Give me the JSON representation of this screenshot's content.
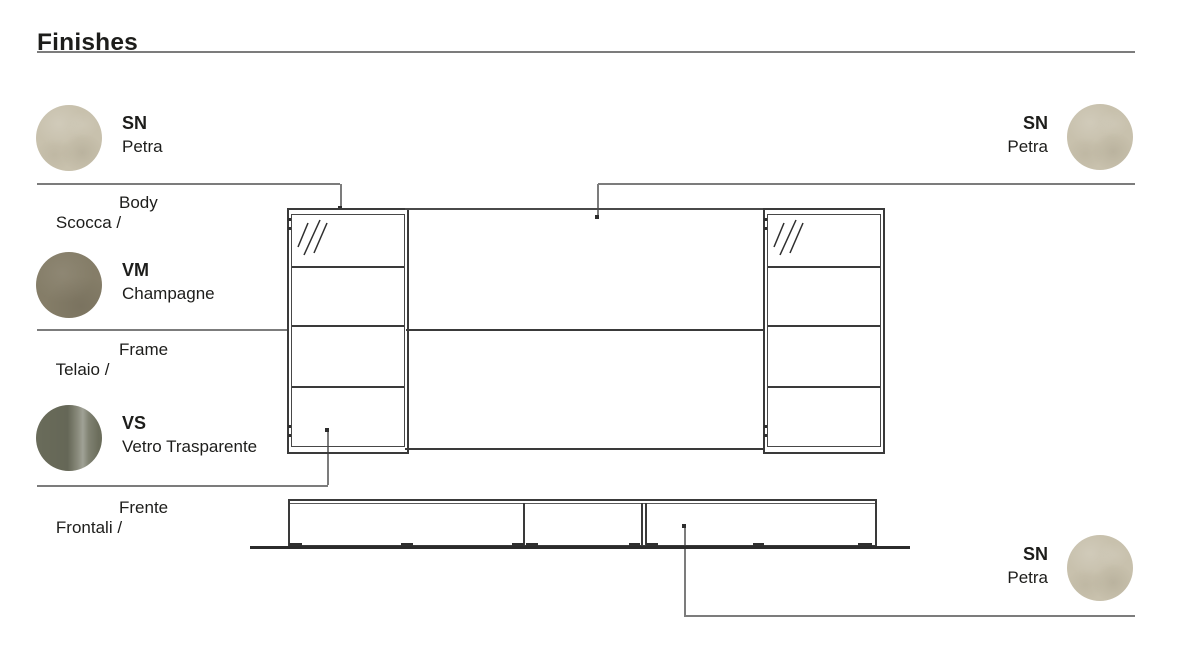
{
  "page": {
    "title": "Finishes"
  },
  "sections": {
    "body": {
      "label_primary": "Scocca /",
      "label_secondary": "Body",
      "swatch": {
        "code": "SN",
        "name": "Petra",
        "color": "#c8c1ad"
      }
    },
    "frame": {
      "label_primary": "Telaio /",
      "label_secondary": "Frame",
      "swatch": {
        "code": "VM",
        "name": "Champagne",
        "color": "#857d68"
      }
    },
    "front": {
      "label_primary": "Frontali /",
      "label_secondary": "Frente",
      "swatch": {
        "code": "VS",
        "name": "Vetro Trasparente",
        "color": "#6f715f"
      }
    },
    "panel_top": {
      "swatch": {
        "code": "SN",
        "name": "Petra",
        "color": "#c8c1ad"
      }
    },
    "base_bottom": {
      "swatch": {
        "code": "SN",
        "name": "Petra",
        "color": "#c8c1ad"
      }
    }
  },
  "palette": {
    "background": "#ffffff",
    "text": "#1d1d1b",
    "leader_line": "#7c7c7c",
    "drawing_line": "#3a3a3a"
  }
}
